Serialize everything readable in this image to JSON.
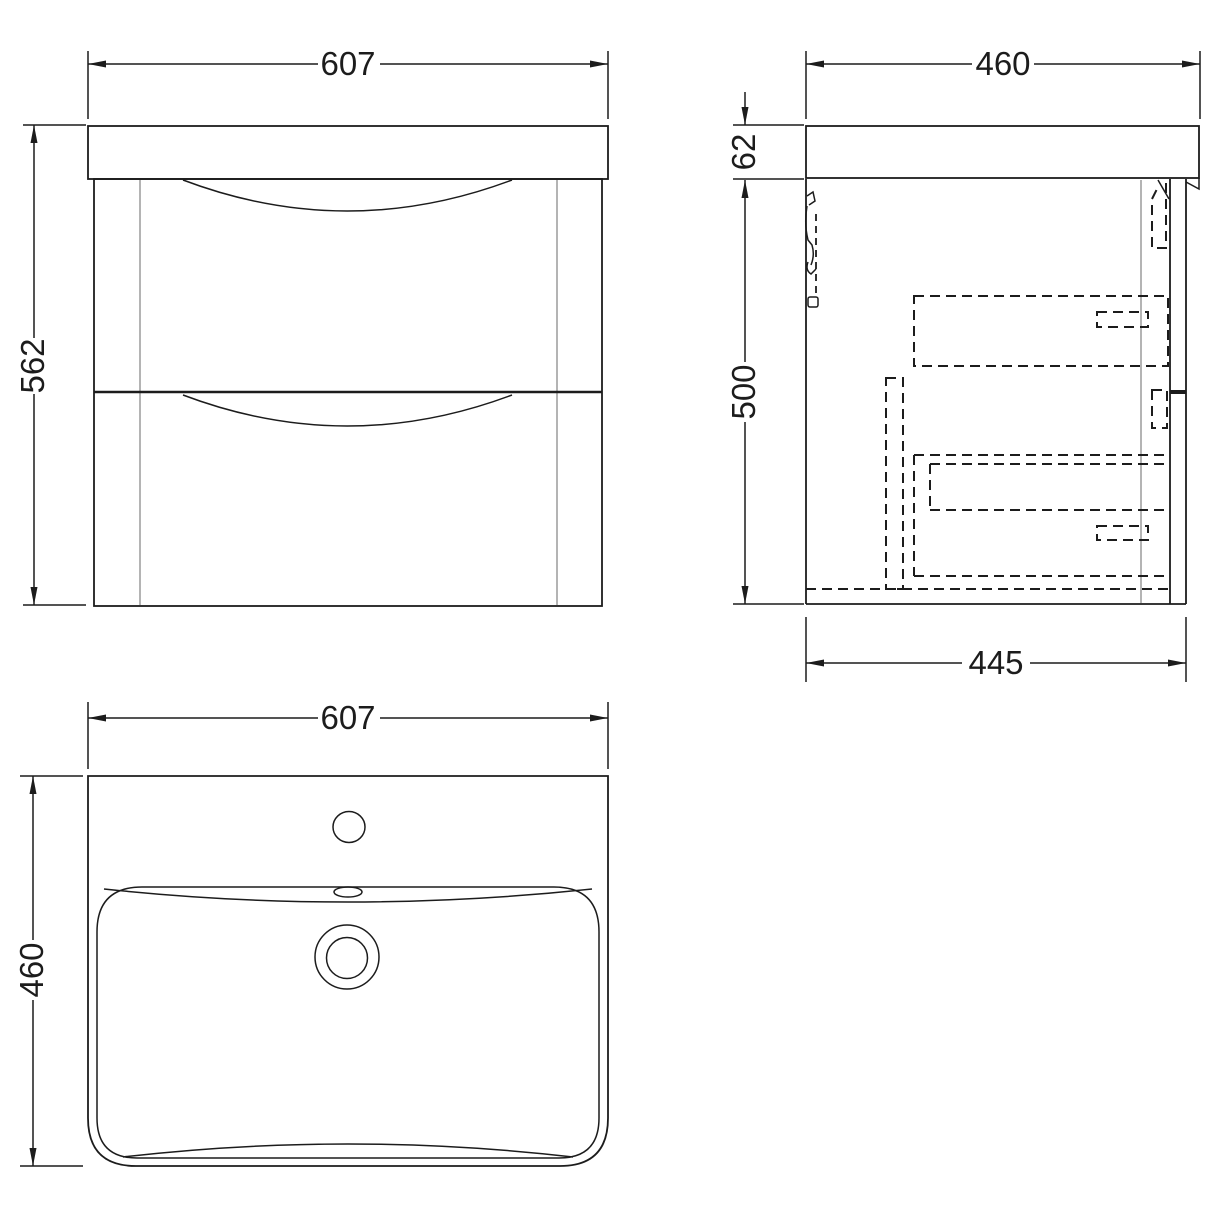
{
  "drawing": {
    "title": "wall-hung-vanity-unit-with-basin-technical-drawing",
    "colors": {
      "line": "#1c1c1c",
      "grey_panel_line": "#9b9b9b",
      "background": "#ffffff"
    },
    "views": {
      "front": {
        "label": "front-view",
        "width": "607",
        "height": "562"
      },
      "side": {
        "label": "side-view",
        "overall_depth": "460",
        "countertop_thickness": "62",
        "cabinet_height": "500",
        "cabinet_depth": "445"
      },
      "top": {
        "label": "top-view-basin",
        "width": "607",
        "depth": "460"
      }
    }
  }
}
